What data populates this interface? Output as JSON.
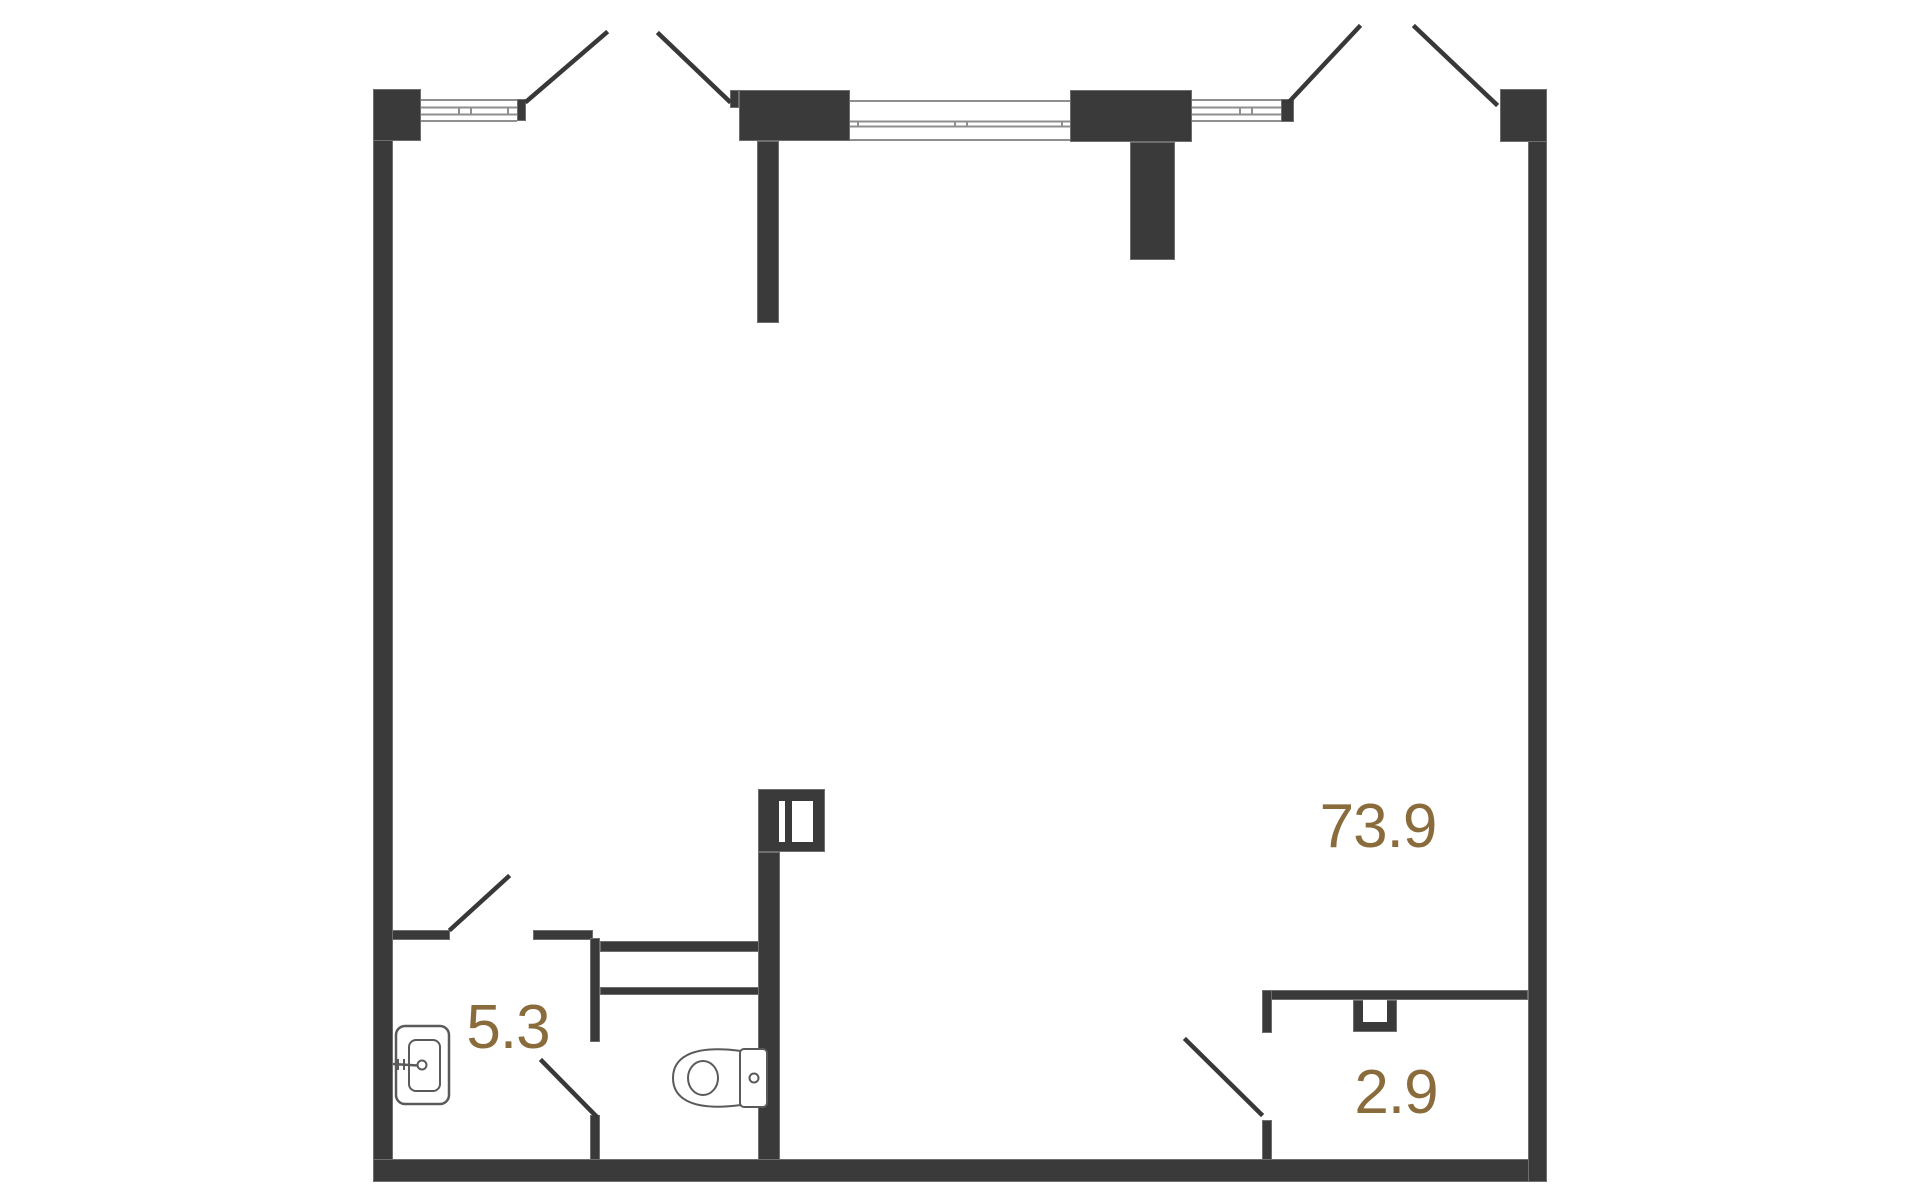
{
  "floorplan": {
    "background_color": "#ffffff",
    "wall_color": "#3a3a3a",
    "wall_edge_color": "#6e6e6e",
    "window_line_color": "#8f8f8f",
    "fixture_line_color": "#5a5a5a",
    "door_swing_color": "#383838",
    "area_label_color": "#8a6c3c",
    "areas": [
      {
        "name": "main-room",
        "area_label": "73.9"
      },
      {
        "name": "bathroom",
        "area_label": "5.3"
      },
      {
        "name": "closet",
        "area_label": "2.9"
      }
    ],
    "fixtures": [
      "sink-icon",
      "toilet-icon",
      "ventilation-shaft-icon",
      "wall-box-icon"
    ]
  }
}
